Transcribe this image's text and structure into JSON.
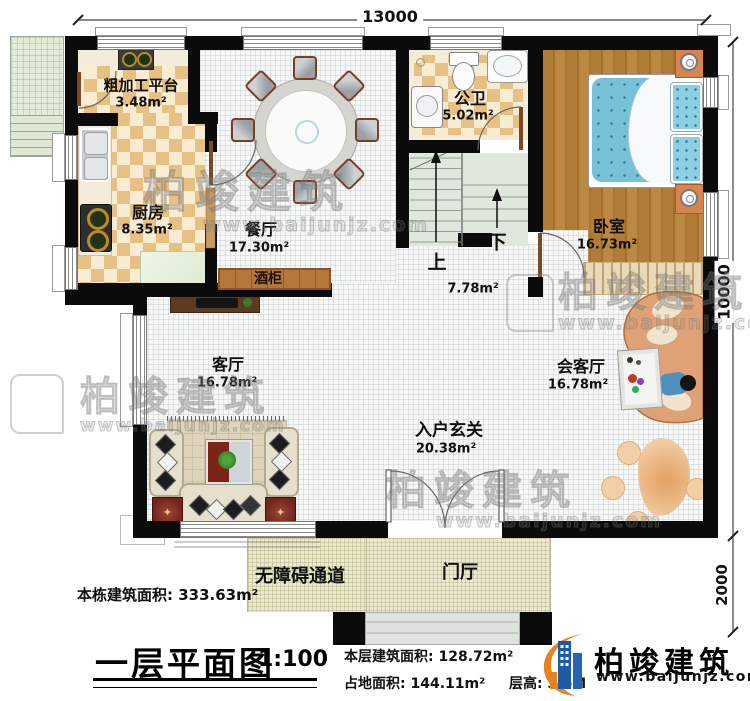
{
  "meta": {
    "drawing_title": "一层平面图",
    "scale": "1:100"
  },
  "dimensions": {
    "top_width": "13000",
    "right_height": "10000",
    "porch_depth": "2000"
  },
  "rooms": {
    "rough_platform": {
      "name": "粗加工平台",
      "area": "3.48m²"
    },
    "kitchen": {
      "name": "厨房",
      "area": "8.35m²"
    },
    "dining": {
      "name": "餐厅",
      "area": "17.30m²"
    },
    "bathroom": {
      "name": "公卫",
      "area": "5.02m²"
    },
    "bedroom": {
      "name": "卧室",
      "area": "16.73m²"
    },
    "stairwell": {
      "up": "上",
      "down": "下",
      "area": "7.78m²"
    },
    "living": {
      "name": "客厅",
      "area": "16.78m²"
    },
    "reception": {
      "name": "会客厅",
      "area": "16.78m²"
    },
    "foyer": {
      "name": "入户玄关",
      "area": "20.38m²"
    },
    "wine_cabinet": {
      "name": "酒柜"
    },
    "porch": {
      "name": "门厅"
    },
    "ramp": {
      "name": "无障碍通道"
    }
  },
  "annotations": {
    "building_total_label": "本栋建筑面积:",
    "building_total_value": "333.63m²",
    "floor_area_label": "本层建筑面积:",
    "floor_area_value": "128.72m²",
    "footprint_label": "占地面积:",
    "footprint_value": "144.11m²",
    "floor_height_label": "层高:",
    "floor_height_value": "3.6M"
  },
  "brand": {
    "name": "柏竣建筑",
    "website": "www.baijunjz.com",
    "blue": "#1d5ba6",
    "orange": "#e8821e"
  },
  "watermark": {
    "name": "柏竣建筑",
    "website": "www.baijunjz.com"
  }
}
